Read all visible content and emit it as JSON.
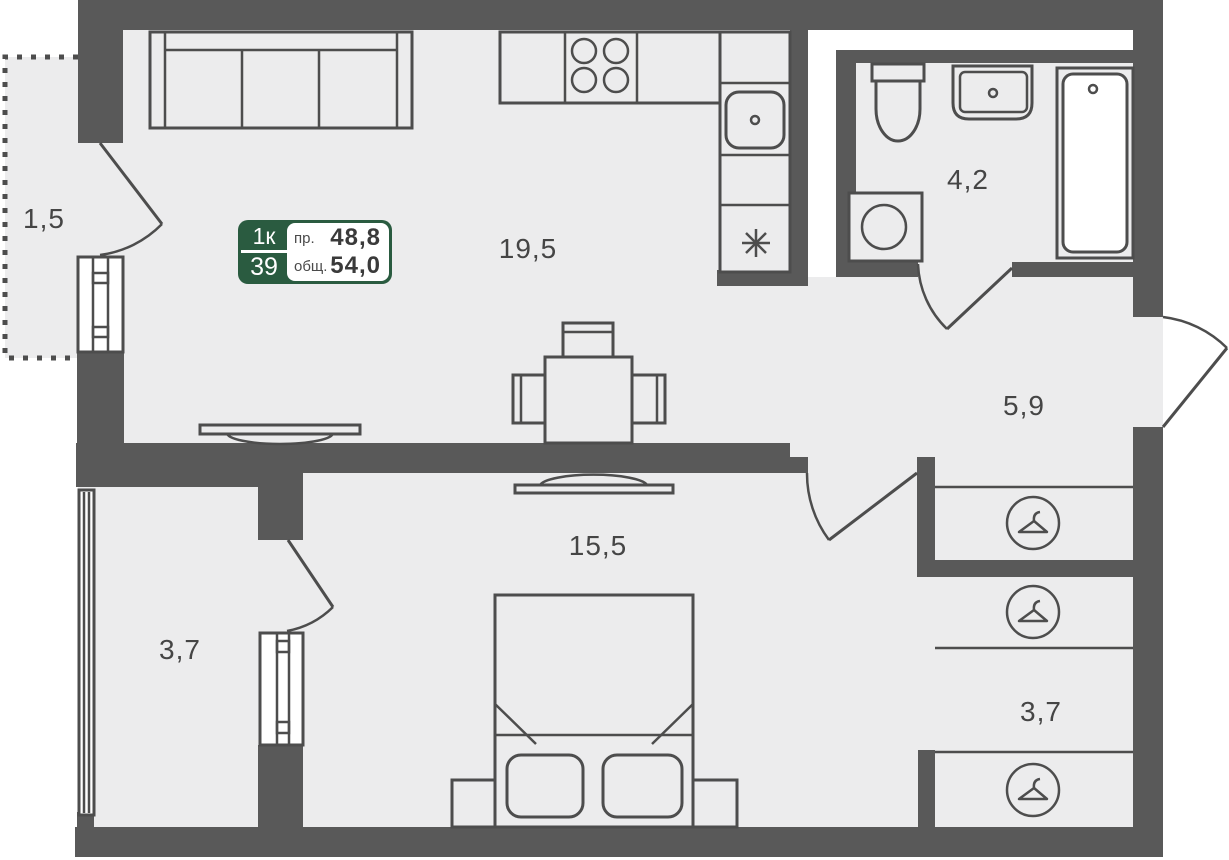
{
  "colors": {
    "wall": "#595959",
    "line": "#4d4d4d",
    "floor": "#ececed",
    "badge_green": "#2a5b40",
    "text": "#454545"
  },
  "badge": {
    "type": "1к",
    "number": "39",
    "row1_label": "пр.",
    "row1_value": "48,8",
    "row2_label": "общ.",
    "row2_value": "54,0"
  },
  "rooms": [
    {
      "id": "balcony",
      "area": "1,5"
    },
    {
      "id": "kitchen-living-room",
      "area": "19,5"
    },
    {
      "id": "bathroom",
      "area": "4,2"
    },
    {
      "id": "hallway",
      "area": "5,9"
    },
    {
      "id": "bedroom",
      "area": "15,5"
    },
    {
      "id": "office",
      "area": "3,7"
    },
    {
      "id": "wardrobe-area",
      "area": "3,7"
    }
  ],
  "icons": {
    "hanger": "wardrobe hanger symbol",
    "fridge": "snowflake asterisk",
    "stove": "4 burners",
    "sink": "kitchen sink",
    "toilet": "toilet",
    "washbasin": "washbasin",
    "bathtub": "bathtub",
    "washing_machine": "washing machine",
    "sofa": "sofa",
    "bed": "double bed",
    "tv": "tv on wall",
    "dining": "table with chairs"
  }
}
